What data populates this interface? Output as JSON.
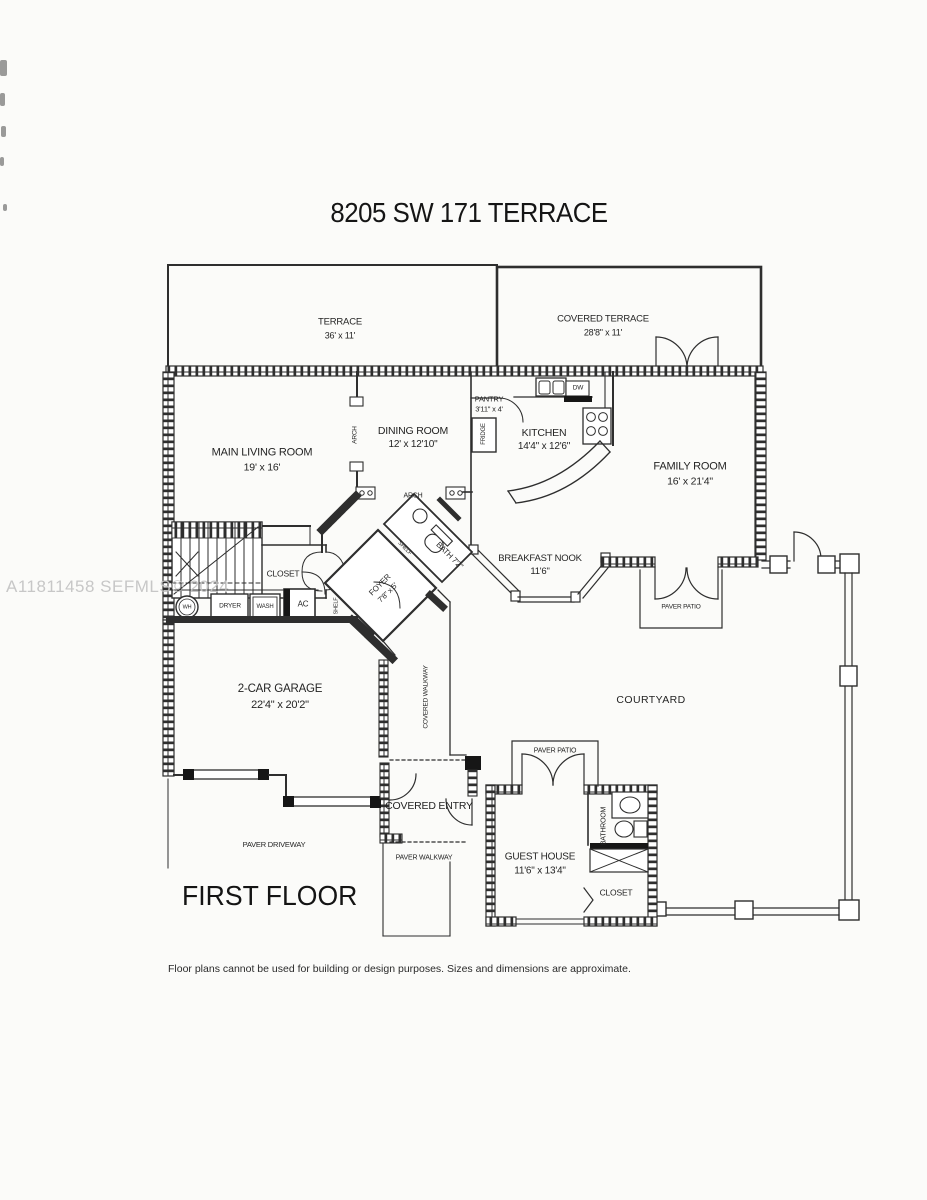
{
  "page": {
    "title": "8205 SW 171 TERRACE",
    "watermark": "A11811458 SEFMLS© 2024",
    "floor_label": "FIRST FLOOR",
    "disclaimer": "Floor plans cannot be used for building or design purposes. Sizes and dimensions are approximate."
  },
  "rooms": {
    "terrace": {
      "name": "TERRACE",
      "dims": "36' x 11'"
    },
    "covered_terrace": {
      "name": "COVERED TERRACE",
      "dims": "28'8\" x 11'"
    },
    "main_living_room": {
      "name": "MAIN LIVING ROOM",
      "dims": "19' x 16'"
    },
    "dining_room": {
      "name": "DINING ROOM",
      "dims": "12' x 12'10\""
    },
    "pantry": {
      "name": "PANTRY",
      "dims": "3'11\" x 4'"
    },
    "kitchen": {
      "name": "KITCHEN",
      "dims": "14'4\" x 12'6\""
    },
    "family_room": {
      "name": "FAMILY ROOM",
      "dims": "16' x 21'4\""
    },
    "breakfast_nook": {
      "name": "BREAKFAST NOOK",
      "dims": "11'6\""
    },
    "foyer": {
      "name": "FOYER",
      "dims": "7'8\" x 5'"
    },
    "bath": {
      "name": "BATH 7'2\""
    },
    "closet_main": {
      "name": "CLOSET"
    },
    "garage": {
      "name": "2-CAR GARAGE",
      "dims": "22'4\" x 20'2\""
    },
    "guest_house": {
      "name": "GUEST HOUSE",
      "dims": "11'6\" x 13'4\""
    },
    "guest_bathroom": {
      "name": "BATHROOM"
    },
    "guest_closet": {
      "name": "CLOSET"
    }
  },
  "areas": {
    "courtyard": "COURTYARD",
    "covered_walkway": "COVERED WALKWAY",
    "covered_entry": "COVERED ENTRY",
    "paver_walkway": "PAVER WALKWAY",
    "paver_driveway": "PAVER DRIVEWAY",
    "paver_patio_family": "PAVER PATIO",
    "paver_patio_guest": "PAVER PATIO"
  },
  "fixtures": {
    "arch_living": "ARCH",
    "arch_dining": "ARCH",
    "shelf_upper": "SHELF",
    "shelf_lower": "SHELF",
    "fridge": "FRIDGE",
    "dishwasher": "DW",
    "water_heater": "WH",
    "dryer": "DRYER",
    "washer": "WASH",
    "ac": "AC"
  },
  "colors": {
    "line": "#2e2e2e",
    "watermark": "#c2c2c2",
    "background": "#fbfbf9"
  }
}
